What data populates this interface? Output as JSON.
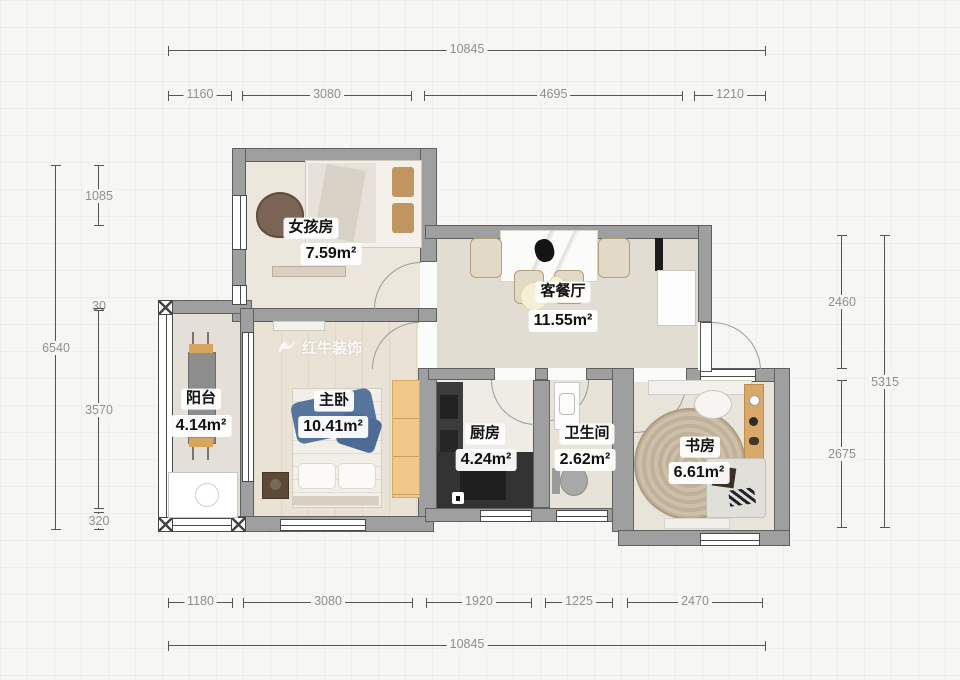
{
  "watermark": {
    "brand": "红牛装饰"
  },
  "rooms": {
    "girls": {
      "name": "女孩房",
      "area": "7.59m²"
    },
    "living": {
      "name": "客餐厅",
      "area": "11.55m²"
    },
    "balcony": {
      "name": "阳台",
      "area": "4.14m²"
    },
    "master": {
      "name": "主卧",
      "area": "10.41m²"
    },
    "kitchen": {
      "name": "厨房",
      "area": "4.24m²"
    },
    "bath": {
      "name": "卫生间",
      "area": "2.62m²"
    },
    "study": {
      "name": "书房",
      "area": "6.61m²"
    }
  },
  "dims": {
    "top_total": "10845",
    "top_segments": [
      "1160",
      "3080",
      "4695",
      "1210"
    ],
    "left_total": "6540",
    "left_segments": [
      "1085",
      "30",
      "3570",
      "320"
    ],
    "right_total": "5315",
    "right_segments": [
      "2460",
      "2675"
    ],
    "bottom_segments": [
      "1180",
      "3080",
      "1920",
      "1225",
      "2470"
    ],
    "bottom_total": "10845"
  },
  "colors": {
    "wall": "#9f9f9f",
    "wall_edge": "#5a5a5a",
    "dim_line": "#555555",
    "dim_text": "#8f8f8f",
    "label_text": "#111111",
    "wood_accent": "#d9a55c",
    "wardrobe": "#f0c88a",
    "counter_dark": "#343434",
    "blanket_blue": "#56749c",
    "rug": "#c2b5a0"
  }
}
